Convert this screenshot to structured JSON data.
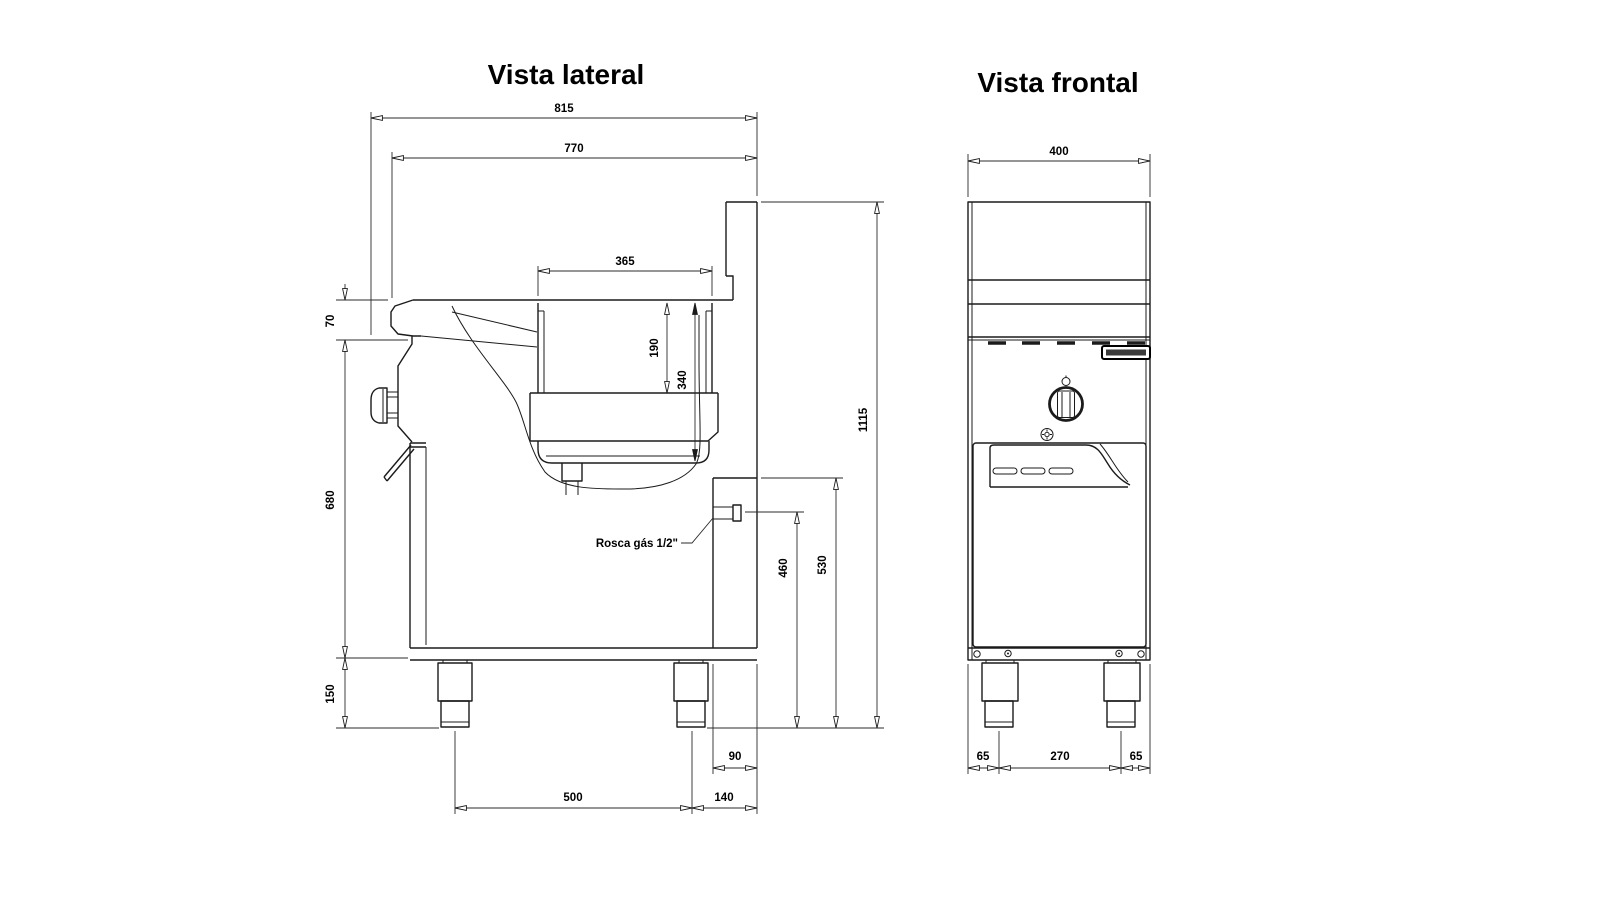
{
  "drawing": {
    "background": "#ffffff",
    "line_color": "#1b1b1b"
  },
  "side_view": {
    "title": "Vista lateral",
    "dimensions": {
      "overall_depth": "815",
      "top_depth": "770",
      "tank_opening_width": "365",
      "tank_depth": "190",
      "tank_total_depth": "340",
      "worktop_lip": "70",
      "body_height": "680",
      "leg_height": "150",
      "overall_height": "1115",
      "gas_panel_top_height": "530",
      "gas_inlet_height": "460",
      "rear_channel_depth": "90",
      "leg_pitch_depth": "500",
      "rear_leg_offset": "140"
    },
    "annotations": {
      "gas_thread_label": "Rosca gás 1/2\""
    }
  },
  "front_view": {
    "title": "Vista frontal",
    "dimensions": {
      "overall_width": "400",
      "left_leg_offset": "65",
      "leg_pitch_width": "270",
      "right_leg_offset": "65"
    }
  }
}
